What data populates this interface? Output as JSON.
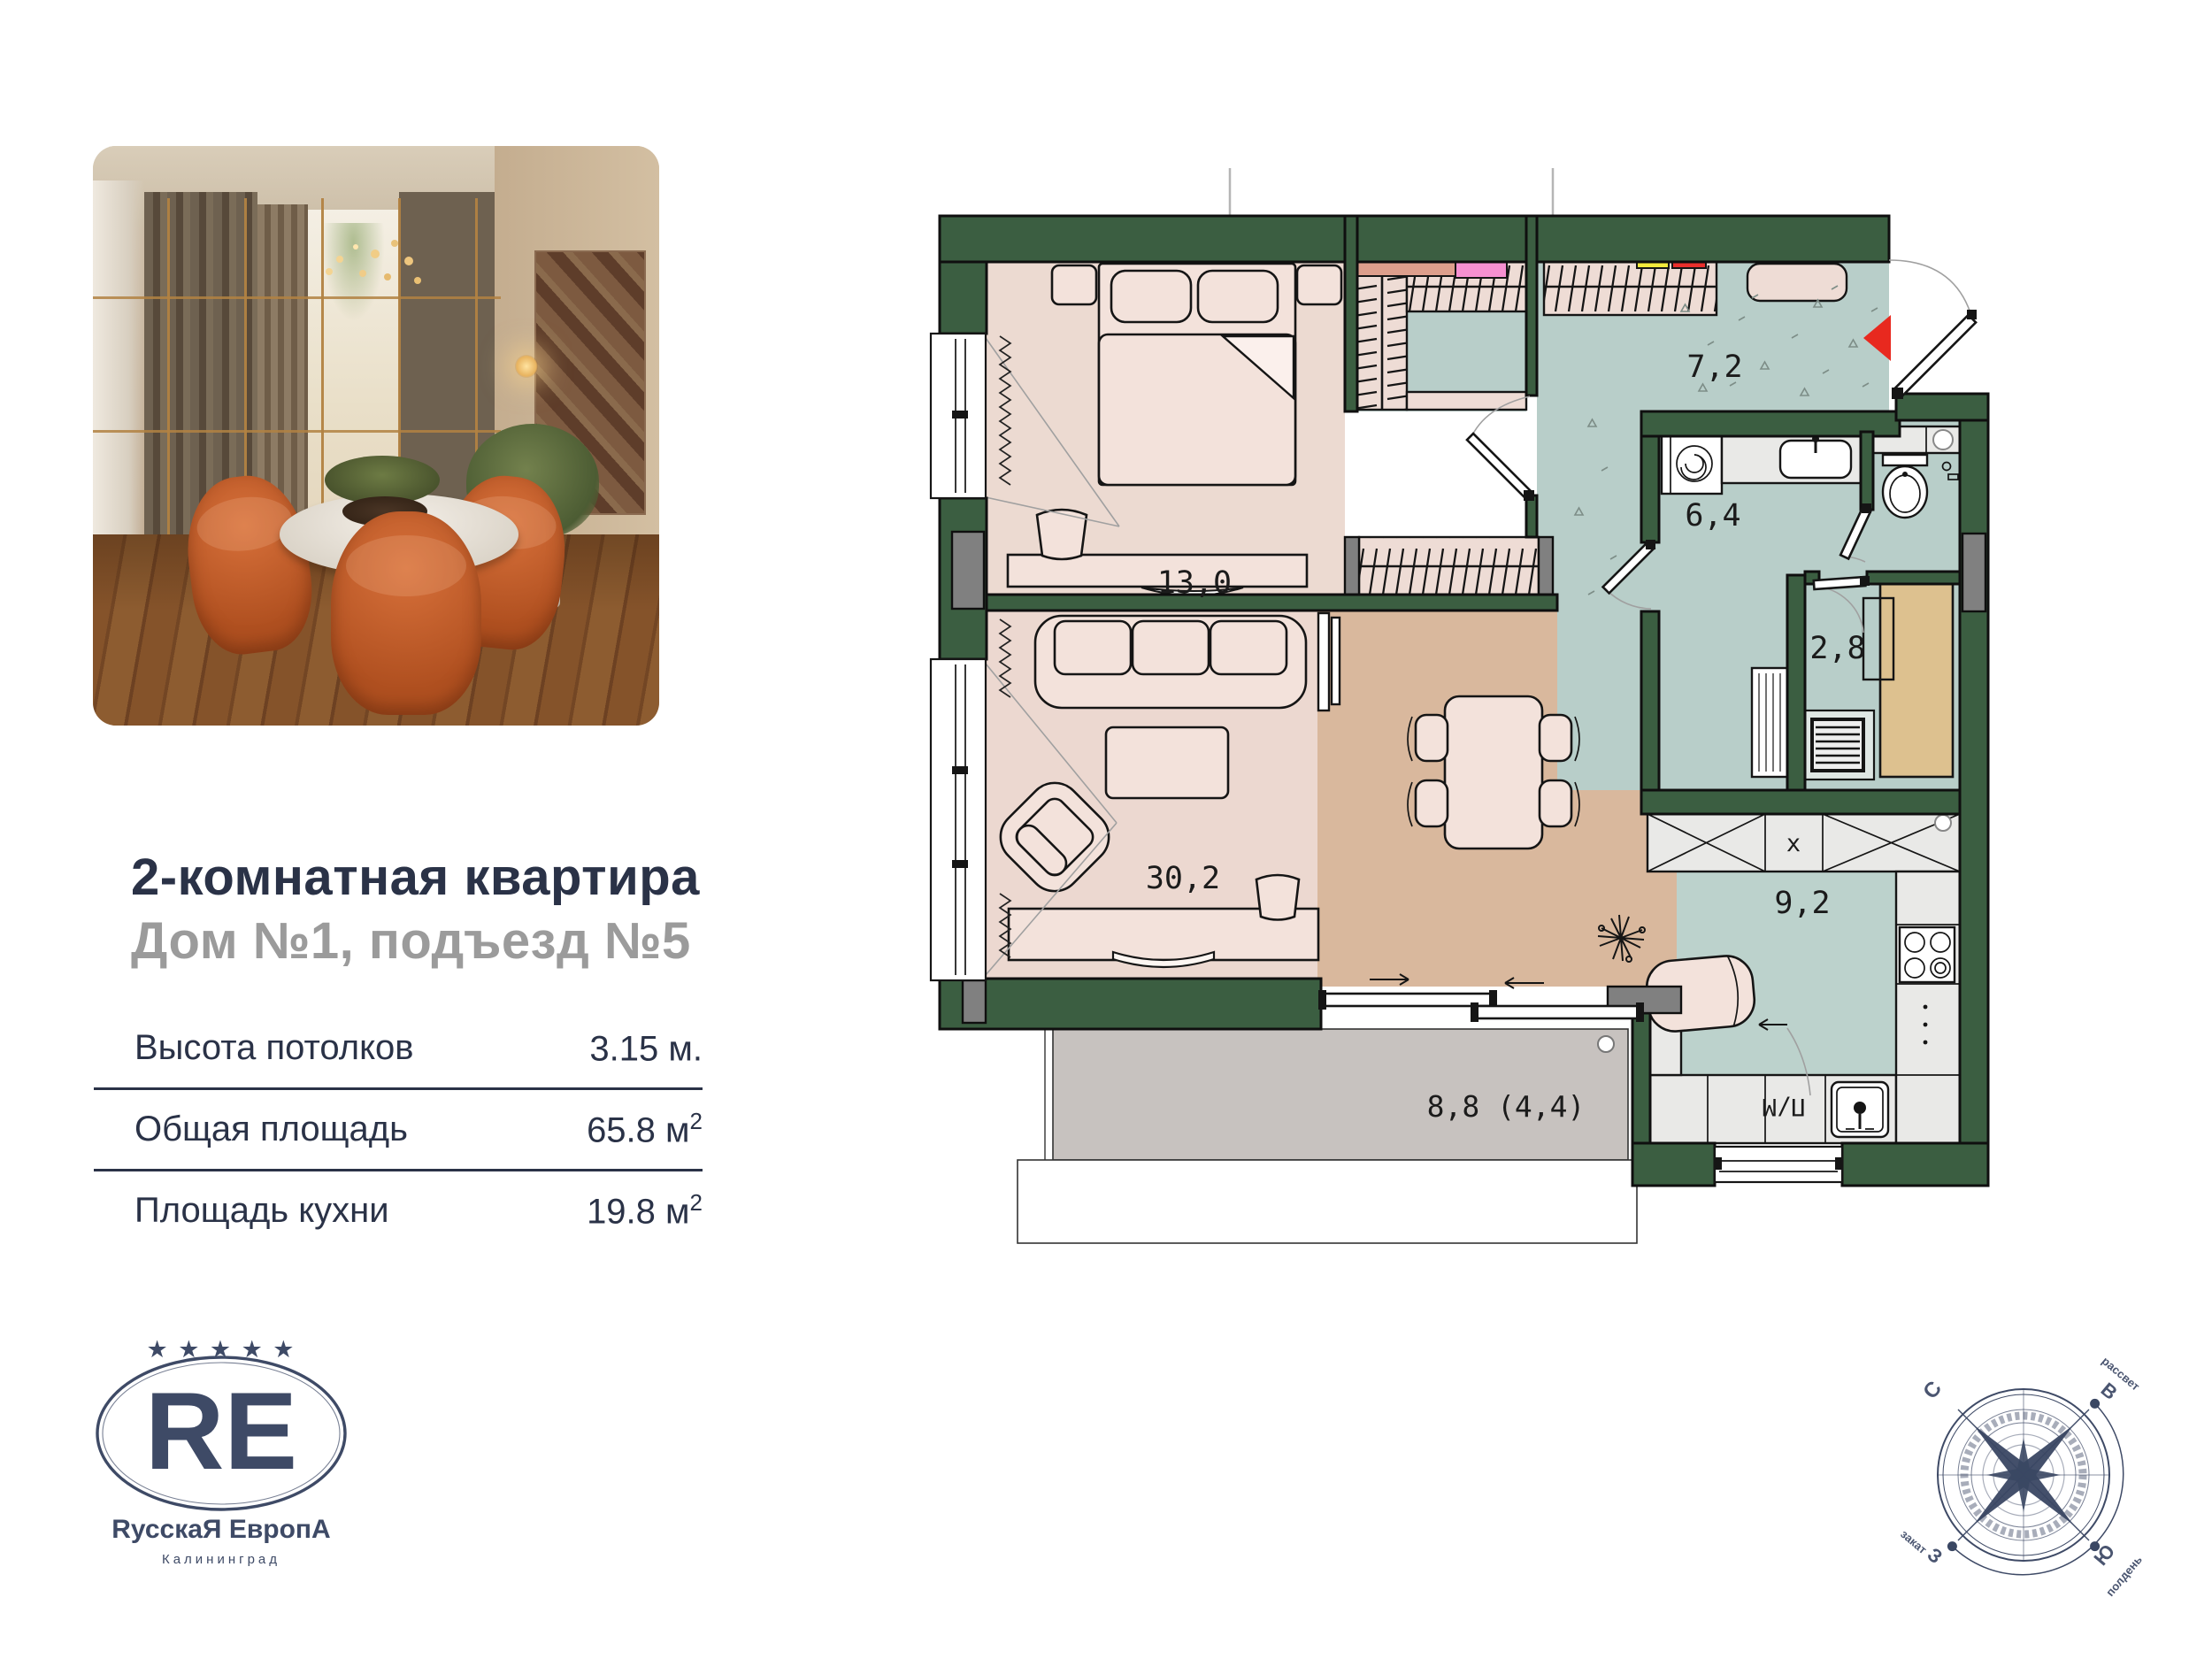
{
  "panel": {
    "title": "2-комнатная квартира",
    "subtitle": "Дом №1, подъезд №5",
    "specs": [
      {
        "label": "Высота потолков",
        "value": "3.15 м.",
        "sup": ""
      },
      {
        "label": "Общая площадь",
        "value": "65.8 м",
        "sup": "2"
      },
      {
        "label": "Площадь кухни",
        "value": "19.8 м",
        "sup": "2"
      }
    ]
  },
  "logo": {
    "stars": "★ ★ ★ ★ ★",
    "monogram": "RE",
    "name": "RусскаЯ ЕвропА",
    "city": "Калининград",
    "color": "#3e4a66"
  },
  "plan": {
    "labels": {
      "bedroom": "13,0",
      "living": "30,2",
      "hallway": "7,2",
      "bathroom": "6,4",
      "storage": "2,8",
      "kitchen": "9,2",
      "balcony": "8,8 (4,4)",
      "dishwasher": "П/М",
      "vent": "х"
    },
    "colors": {
      "wall_green": "#3b5e41",
      "bedroom_floor": "#ecdad1",
      "living_floor": "#ecd8d0",
      "dining_floor": "#d9b89d",
      "wet_floor": "#b8cec9",
      "kitchen_floor": "#bcd2cc",
      "balcony_floor": "#c7c2bf",
      "entry_marker_red": "#e8291f",
      "cabinet_tan": "#ddc18f"
    }
  },
  "compass": {
    "north": "С",
    "east": "В",
    "south": "Ю",
    "west": "З",
    "dawn": "рассвет",
    "noon": "полдень",
    "sunset": "закат"
  }
}
